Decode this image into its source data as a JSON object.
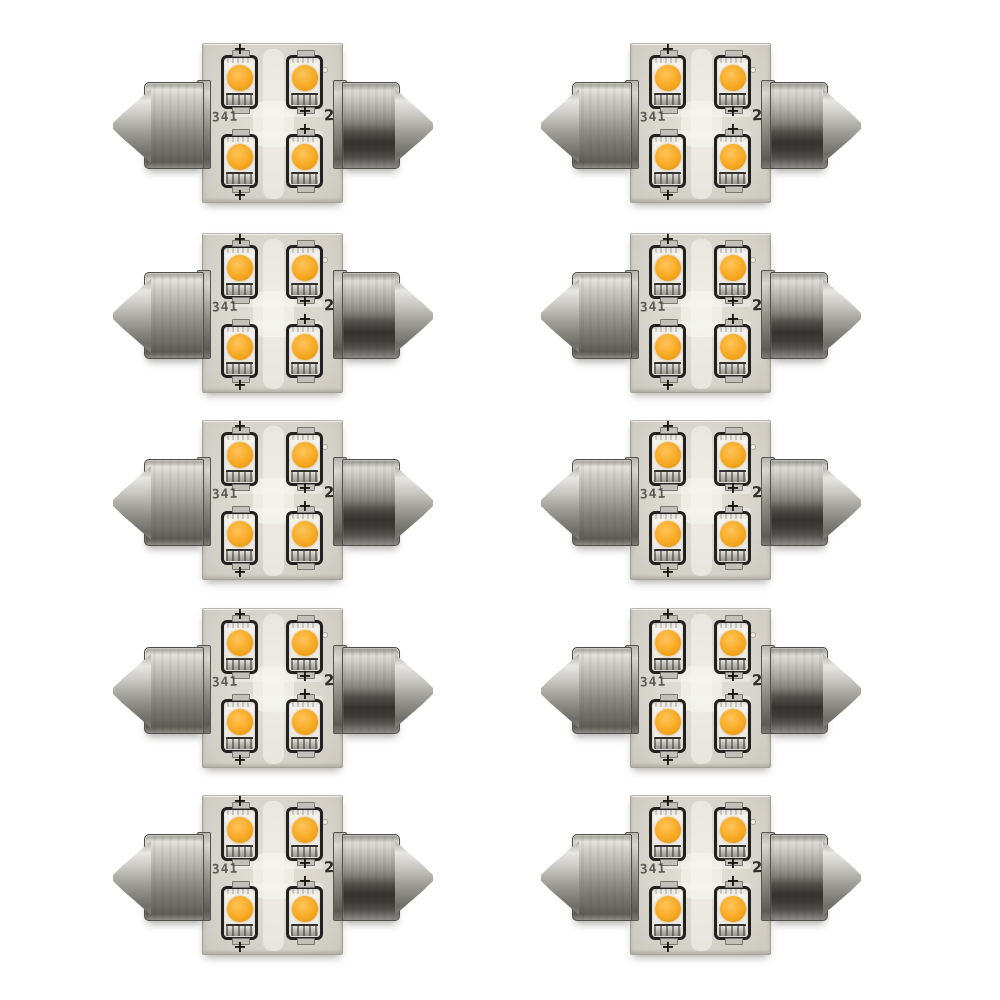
{
  "page": {
    "background_color": "#ffffff",
    "content_type": "product photo",
    "subject": "10-pack of festoon LED interior light bulbs on a white background"
  },
  "grid": {
    "rows": 5,
    "columns": 2,
    "bulb_count": 10,
    "column_x_px": [
      113,
      541
    ],
    "row_y_px": [
      43,
      233,
      420,
      608,
      795
    ],
    "bulb_width_px": 320,
    "bulb_height_px": 160
  },
  "bulb": {
    "name": "festoon LED bulb",
    "led_count": 4,
    "date_code": "1341",
    "wattage_marking": "20",
    "polarity_symbol": "+",
    "colors": {
      "pcb_base": "#d8d5cc",
      "pcb_trace": "#f2f1ec",
      "led_phosphor_orange": "#f3a31b",
      "led_package_outline": "#22211f",
      "led_package_body": "#f2f0ea",
      "metal_highlight": "#e3e2de",
      "metal_mid": "#a5a39d",
      "metal_dark": "#343330"
    }
  }
}
